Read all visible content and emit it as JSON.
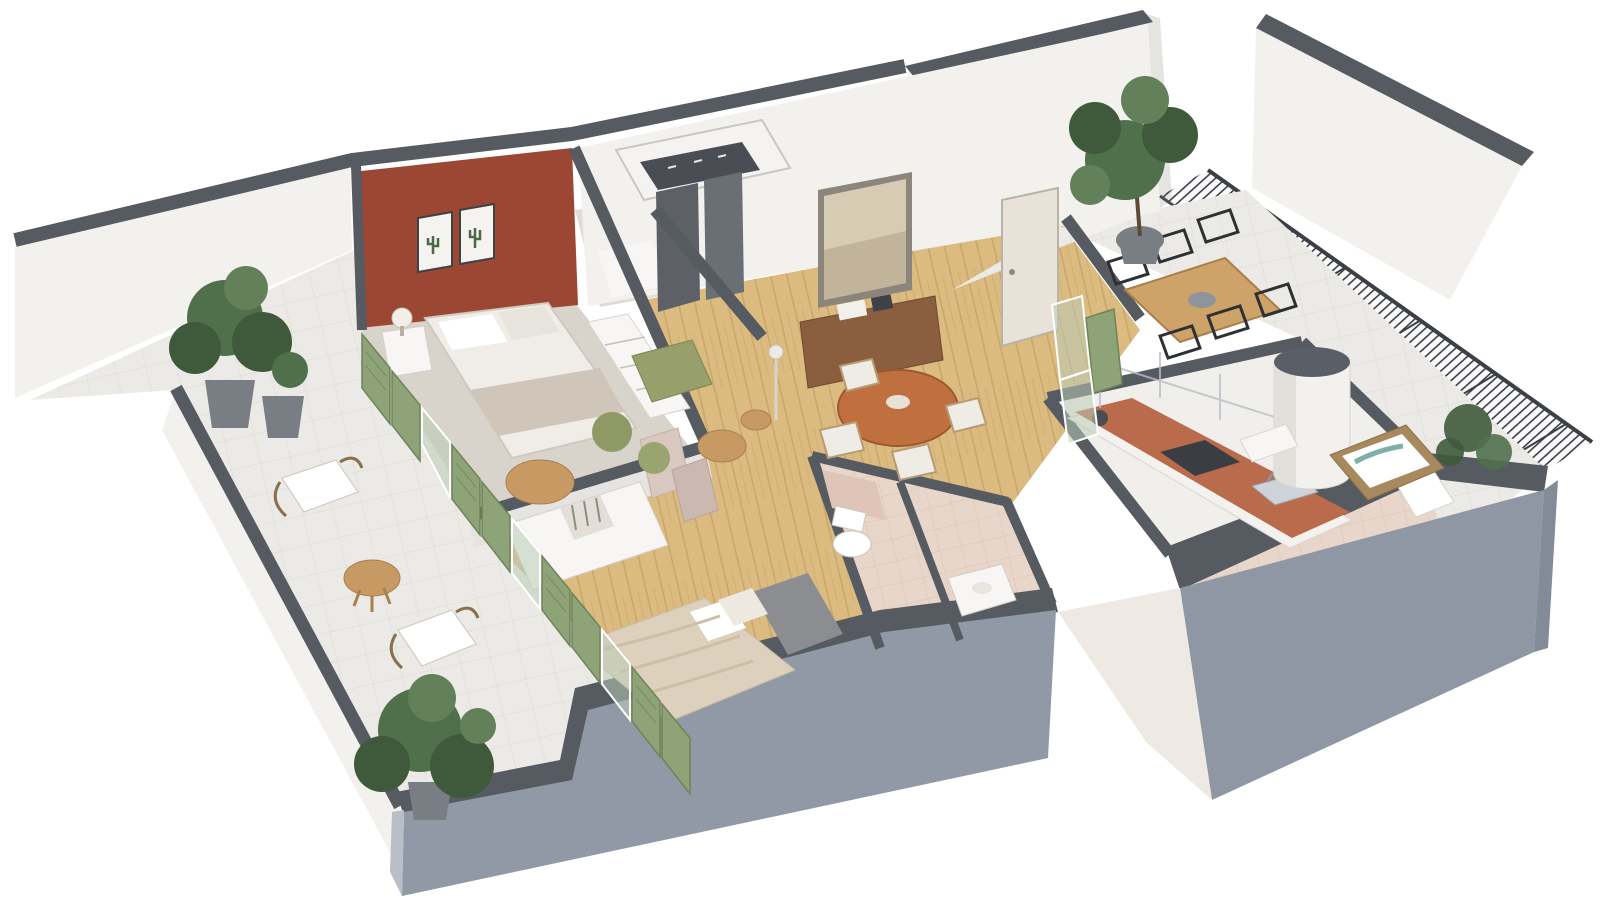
{
  "scene": {
    "kind": "3d-isometric-floor-plan-render",
    "description": "Photorealistic 3D cutaway floor plan of an apartment viewed from above at an angle, white background, no text labels",
    "background_color": "#ffffff"
  },
  "palette": {
    "wall_top_cap": "#565a61",
    "exterior_gray_face": "#9199a6",
    "white_wall": "#f2f1ee",
    "accent_red_wall": "#9c4733",
    "wood_floor": "#dcbb80",
    "terrace_tile": "#eceae6",
    "bathroom_tile": "#e9d6ca",
    "kitchen_counter_terracotta": "#b96b4b",
    "green_shutters": "#8ea377",
    "olive_armchair": "#97a06b",
    "plant_green": "#3f5a3b",
    "railing_dark": "#3c4046"
  },
  "rooms": [
    {
      "id": "master-bedroom",
      "features": [
        "terracotta accent wall",
        "two cactus art frames",
        "double bed with white bedding",
        "nightstand with lamp",
        "white shelving unit",
        "round side table",
        "blush folding screens"
      ]
    },
    {
      "id": "left-terrace",
      "features": [
        "white tile floor",
        "two rattan lounge chairs with white cushions",
        "round wooden side table",
        "large potted plants",
        "green louvered shutters",
        "white parapet wall"
      ]
    },
    {
      "id": "entry-hall",
      "features": [
        "recessed ceiling slab with spotlights",
        "white bench",
        "dark gray wardrobe columns"
      ]
    },
    {
      "id": "living-dining-room",
      "features": [
        "oak parquet floor",
        "walnut sideboard with books and decor",
        "large framed landscape artwork",
        "beige terrace door",
        "round wooden dining table with four chairs",
        "olive armchair",
        "two olive poufs",
        "two round coffee tables",
        "floor lamp"
      ]
    },
    {
      "id": "second-bedroom",
      "features": [
        "oak parquet floor",
        "double bed with linen bedding and gray headboard",
        "white wardrobe with open shelving"
      ]
    },
    {
      "id": "bathroom",
      "features": [
        "blush tile floor and half walls",
        "wall-hung toilet",
        "vanity unit"
      ]
    },
    {
      "id": "kitchen",
      "features": [
        "galley layout",
        "terracotta countertop",
        "dark cooktop",
        "steel sink with faucet",
        "coffee machine",
        "glass screen above counter"
      ]
    },
    {
      "id": "shower-room",
      "features": [
        "beige tile floor",
        "shower tray with glass panel",
        "washbasin"
      ]
    },
    {
      "id": "right-terrace",
      "features": [
        "large potted tree",
        "wooden outdoor dining table with six black metal chairs",
        "white cylindrical column",
        "rattan daybed-spa with white cushions",
        "olive shrubs",
        "black mesh guard railing",
        "gray parapet walls",
        "green glass privacy screens"
      ]
    }
  ],
  "exterior": {
    "background_building": "tall white party walls with dark copings at top right",
    "south_faces": "two large slate-gray exterior wall slabs at bottom with white gap between blocks"
  }
}
